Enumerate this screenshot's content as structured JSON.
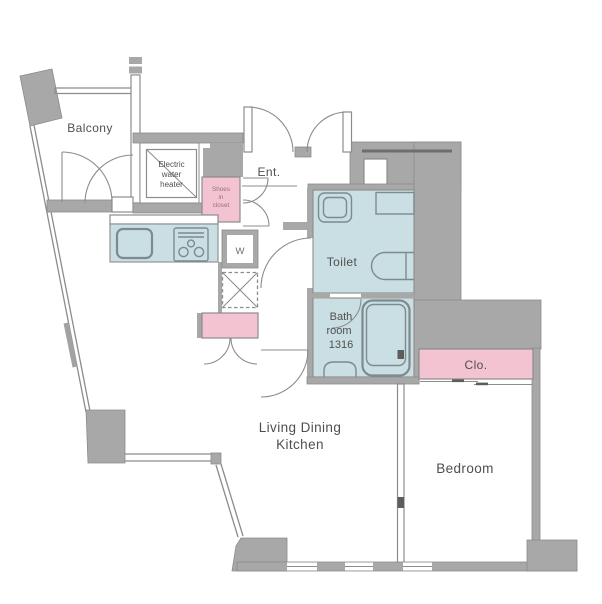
{
  "colors": {
    "wall": "#a8a8a8",
    "line": "#8c8c8c",
    "teal": "#c9dfe3",
    "pink": "#f3c3d2",
    "fixture": "#7d8a8e",
    "text": "#4f4f4f",
    "textsoft": "#96707e",
    "darkline": "#6e6e6e"
  },
  "rooms": {
    "balcony": {
      "label": "Balcony"
    },
    "water_heater": {
      "lines": [
        "Electric",
        "water",
        "heater"
      ]
    },
    "shoes_closet": {
      "lines": [
        "Shoes",
        "in",
        "closet"
      ]
    },
    "entrance": {
      "label": "Ent."
    },
    "washer": {
      "label": "W"
    },
    "toilet": {
      "label": "Toilet"
    },
    "bathroom": {
      "lines": [
        "Bath",
        "room",
        "1316"
      ]
    },
    "closet": {
      "label": "Clo."
    },
    "ldk": {
      "lines": [
        "Living Dining",
        "Kitchen"
      ]
    },
    "bedroom": {
      "label": "Bedroom"
    }
  }
}
